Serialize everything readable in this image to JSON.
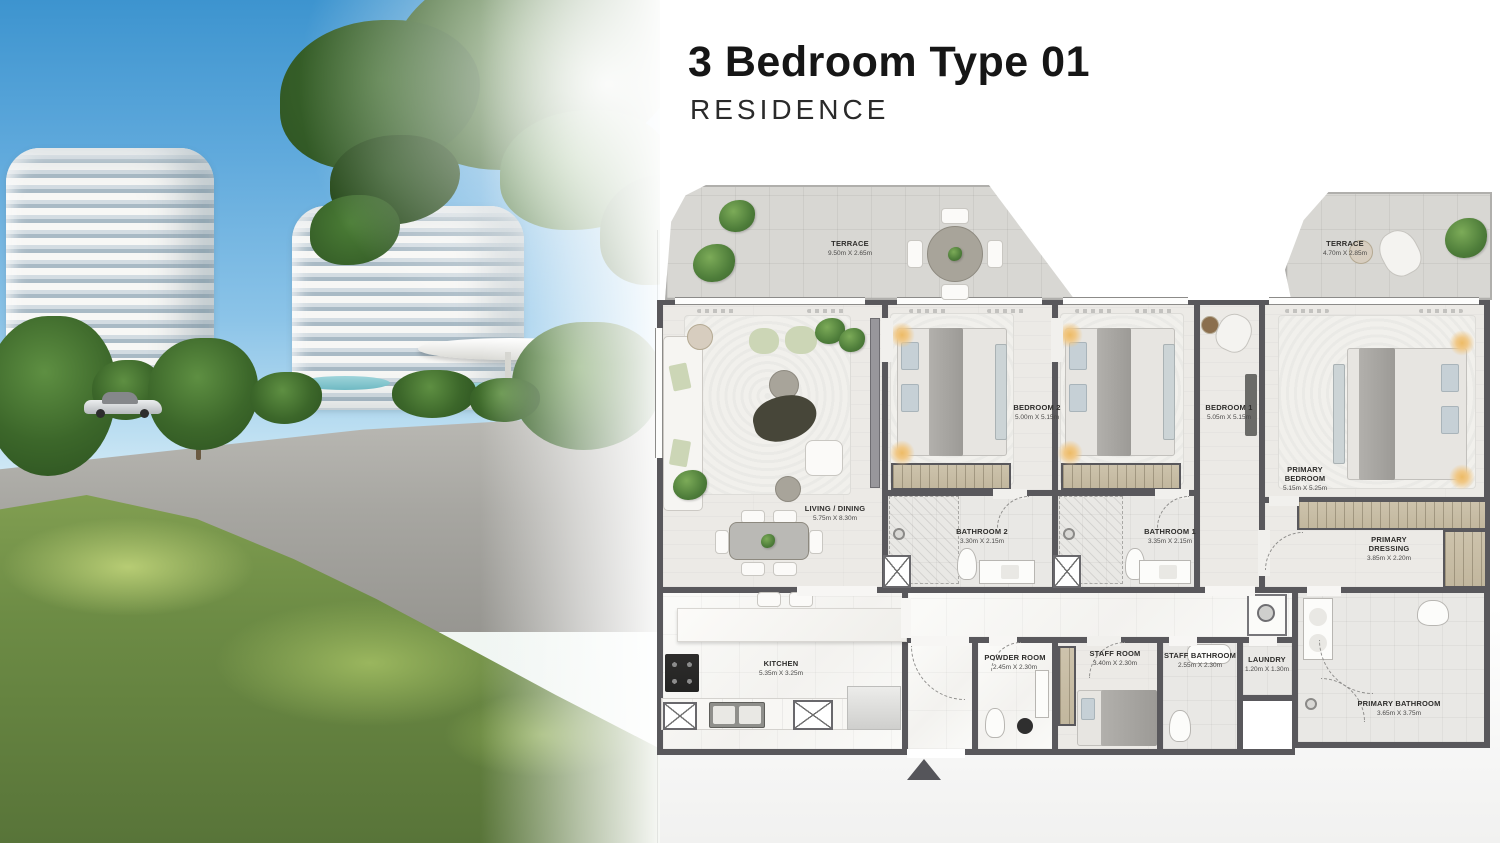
{
  "header": {
    "title": "3 Bedroom Type 01",
    "subtitle": "RESIDENCE"
  },
  "floorplan": {
    "rooms": [
      {
        "id": "terrace-left",
        "name": "TERRACE",
        "dims": "9.50m X 2.65m"
      },
      {
        "id": "terrace-right",
        "name": "TERRACE",
        "dims": "4.70m X 2.85m"
      },
      {
        "id": "living-dining",
        "name": "LIVING / DINING",
        "dims": "5.75m X 8.30m"
      },
      {
        "id": "bedroom-2",
        "name": "BEDROOM 2",
        "dims": "5.00m X 5.15m"
      },
      {
        "id": "bedroom-1",
        "name": "BEDROOM 1",
        "dims": "5.05m X 5.15m"
      },
      {
        "id": "bathroom-2",
        "name": "BATHROOM 2",
        "dims": "3.30m X 2.15m"
      },
      {
        "id": "bathroom-1",
        "name": "BATHROOM 1",
        "dims": "3.35m X 2.15m"
      },
      {
        "id": "primary-bedroom",
        "name": "PRIMARY BEDROOM",
        "dims": "5.15m X 5.25m"
      },
      {
        "id": "primary-dressing",
        "name": "PRIMARY DRESSING",
        "dims": "3.85m X 2.20m"
      },
      {
        "id": "kitchen",
        "name": "KITCHEN",
        "dims": "5.35m X 3.25m"
      },
      {
        "id": "powder-room",
        "name": "POWDER ROOM",
        "dims": "2.45m X 2.30m"
      },
      {
        "id": "staff-room",
        "name": "STAFF ROOM",
        "dims": "3.40m X 2.30m"
      },
      {
        "id": "staff-bathroom",
        "name": "STAFF BATHROOM",
        "dims": "2.55m X 2.30m"
      },
      {
        "id": "laundry",
        "name": "LAUNDRY",
        "dims": "1.20m X 1.30m"
      },
      {
        "id": "primary-bathroom",
        "name": "PRIMARY BATHROOM",
        "dims": "3.65m X 3.75m"
      }
    ]
  },
  "colors": {
    "wall": "#59585c",
    "terrace_floor": "#d8d7d3",
    "wood_floor": "#eceae6",
    "marble_floor": "#f7f6f4",
    "wardrobe_tan": "#c8bda5",
    "plant_green": "#4e7d3a",
    "lamp_glow": "#edbb66",
    "sky_blue": "#5fa9dc",
    "grass_green": "#6d8c45",
    "title_text": "#161616"
  }
}
